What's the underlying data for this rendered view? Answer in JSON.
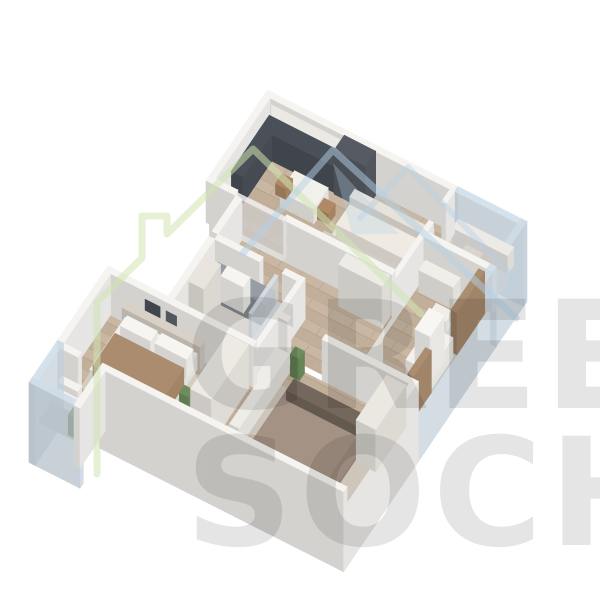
{
  "watermark": {
    "line1": "GREEN",
    "line2": "SOCHI",
    "green_color": "#cfe3b2",
    "blue_color": "#b3cfe6",
    "text_color": "#000000"
  },
  "palette": {
    "background": "#ffffff",
    "wall": "#f5f4f1",
    "glass": "#cfdde8",
    "wood_floor": "#c9b7a3",
    "bath_floor": "#dcd9d4",
    "kitchen_dark": "#4a5058",
    "curtain_brown": "#ab8d70",
    "plant_green": "#6e8d5e",
    "bed_taupe": "#9a897b",
    "blanket_brown": "#ac8c6e"
  },
  "scene": {
    "origin": [
      270,
      140
    ],
    "U": [
      0.75,
      0.38
    ],
    "V": [
      -0.42,
      0.62
    ],
    "items": [
      {
        "t": "box",
        "n": "wall-far-living",
        "u": -8,
        "v": -8,
        "a": 254,
        "b": 8,
        "h": 80,
        "dy": 38,
        "c": "#f5f4f1"
      },
      {
        "t": "decal",
        "n": "kitchen-upper-cabinets",
        "u": 2,
        "v": 0,
        "w": 96,
        "hh": 15,
        "z": 21,
        "c": "#ebe9e4"
      },
      {
        "t": "glass",
        "n": "glazing-office-far",
        "u": 246,
        "v": -8,
        "a": 92,
        "b": 8,
        "h": 80,
        "dy": 38,
        "c": "#cfdde8"
      },
      {
        "t": "box",
        "n": "wall-left-kitchen",
        "u": -8,
        "v": 0,
        "a": 8,
        "b": 130,
        "h": 80,
        "dy": 38,
        "c": "#f5f4f1"
      },
      {
        "t": "floor",
        "n": "floor-living",
        "u": 0,
        "v": 0,
        "a": 240,
        "b": 130,
        "c": "wood"
      },
      {
        "t": "floor",
        "n": "floor-office",
        "u": 246,
        "v": 0,
        "a": 84,
        "b": 65,
        "c": "#d9d4cd"
      },
      {
        "t": "glass",
        "n": "glazing-office-right",
        "u": 330,
        "v": -8,
        "a": 8,
        "b": 73,
        "h": 80,
        "dy": 38,
        "c": "#cfdde8"
      },
      {
        "t": "box",
        "n": "kitchen-counter",
        "u": 0,
        "v": 2,
        "a": 100,
        "b": 22,
        "h": 26,
        "c": "#4a5058"
      },
      {
        "t": "box",
        "n": "kitchen-counter-left",
        "u": 0,
        "v": 24,
        "a": 16,
        "b": 68,
        "h": 26,
        "c": "#4a5058"
      },
      {
        "t": "box",
        "n": "kitchen-tall-cabinet",
        "u": 100,
        "v": 2,
        "a": 42,
        "b": 24,
        "h": 44,
        "c": "#565b63"
      },
      {
        "t": "box",
        "n": "dining-table",
        "u": 55,
        "v": 40,
        "a": 45,
        "b": 34,
        "h": 15,
        "c": "#f2f0ea"
      },
      {
        "t": "box",
        "n": "dining-chair",
        "u": 42,
        "v": 46,
        "a": 14,
        "b": 16,
        "h": 11,
        "c": "#b08a66"
      },
      {
        "t": "box",
        "n": "dining-chair",
        "u": 100,
        "v": 50,
        "a": 15,
        "b": 16,
        "h": 11,
        "c": "#b08a66"
      },
      {
        "t": "floor",
        "n": "rug-living",
        "u": 125,
        "v": 45,
        "a": 113,
        "b": 67,
        "c": "#eae6df"
      },
      {
        "t": "box",
        "n": "sofa-back",
        "u": 132,
        "v": 34,
        "a": 106,
        "b": 12,
        "h": 22,
        "c": "#e7e2da"
      },
      {
        "t": "box",
        "n": "sofa-seat",
        "u": 132,
        "v": 46,
        "a": 106,
        "b": 32,
        "h": 14,
        "c": "#efebe3"
      },
      {
        "t": "box",
        "n": "tv-unit",
        "u": 135,
        "v": 112,
        "a": 97,
        "b": 16,
        "h": 30,
        "c": "#d2ccc4"
      },
      {
        "t": "box",
        "n": "tv-screen",
        "u": 150,
        "v": 116,
        "a": 72,
        "b": 8,
        "h": 28,
        "c": "#272b31"
      },
      {
        "t": "box",
        "n": "plant-pot-living",
        "u": 228,
        "v": 96,
        "a": 12,
        "b": 12,
        "h": 6,
        "c": "#eae7e1"
      },
      {
        "t": "box",
        "n": "plant-living",
        "u": 228,
        "v": 96,
        "a": 12,
        "b": 12,
        "h": 18,
        "dy": -6,
        "c": "#6e8d5e"
      },
      {
        "t": "box",
        "n": "office-desk",
        "u": 252,
        "v": 2,
        "a": 74,
        "b": 14,
        "h": 18,
        "c": "#eceae5"
      },
      {
        "t": "box",
        "n": "office-chair",
        "u": 274,
        "v": 22,
        "a": 22,
        "b": 18,
        "h": 13,
        "c": "#d9d5ce"
      },
      {
        "t": "box",
        "n": "wall-living-divider",
        "u": 240,
        "v": 0,
        "a": 6,
        "b": 20,
        "h": 42,
        "c": "#f5f4f1"
      },
      {
        "t": "box",
        "n": "wall-living-divider",
        "u": 240,
        "v": 50,
        "a": 6,
        "b": 145,
        "h": 42,
        "c": "#f5f4f1"
      },
      {
        "t": "box",
        "n": "wall-living-divider",
        "u": 240,
        "v": 212,
        "a": 6,
        "b": 38,
        "h": 42,
        "c": "#f5f4f1"
      },
      {
        "t": "box",
        "n": "wall-office-nursery",
        "u": 246,
        "v": 65,
        "a": 92,
        "b": 8,
        "h": 42,
        "c": "#f5f4f1"
      },
      {
        "t": "floor",
        "n": "floor-nursery",
        "u": 246,
        "v": 73,
        "a": 84,
        "b": 177,
        "c": "wood"
      },
      {
        "t": "glass",
        "n": "glazing-right",
        "u": 330,
        "v": 65,
        "a": 8,
        "b": 185,
        "h": 80,
        "dy": 38,
        "c": "#cfdde8"
      },
      {
        "t": "box",
        "n": "nursery-dresser",
        "u": 250,
        "v": 76,
        "a": 46,
        "b": 16,
        "h": 22,
        "c": "#f0eee9"
      },
      {
        "t": "box",
        "n": "nursery-table",
        "u": 282,
        "v": 108,
        "a": 22,
        "b": 16,
        "h": 11,
        "c": "#f0eee9"
      },
      {
        "t": "box",
        "n": "nursery-chair",
        "u": 300,
        "v": 94,
        "a": 15,
        "b": 14,
        "h": 9,
        "c": "#efece6"
      },
      {
        "t": "box",
        "n": "curtain-nursery",
        "u": 322,
        "v": 78,
        "a": 8,
        "b": 66,
        "h": 42,
        "c": "#ab8d70"
      },
      {
        "t": "box",
        "n": "crib",
        "u": 296,
        "v": 150,
        "a": 32,
        "b": 55,
        "h": 20,
        "c": "#f3f1ec"
      },
      {
        "t": "box",
        "n": "crib-canopy",
        "u": 302,
        "v": 160,
        "a": 20,
        "b": 34,
        "h": 46,
        "c": "#f7f6f3"
      },
      {
        "t": "box",
        "n": "curtain-nursery",
        "u": 322,
        "v": 205,
        "a": 8,
        "b": 42,
        "h": 42,
        "c": "#ab8d70"
      },
      {
        "t": "box",
        "n": "nursery-wardrobe",
        "u": 248,
        "v": 210,
        "a": 20,
        "b": 38,
        "h": 42,
        "c": "#efede7"
      },
      {
        "t": "box",
        "n": "wall-living-hall",
        "u": -8,
        "v": 130,
        "a": 38,
        "b": 8,
        "h": 42,
        "c": "#f5f4f1"
      },
      {
        "t": "box",
        "n": "wall-living-hall",
        "u": 95,
        "v": 130,
        "a": 145,
        "b": 8,
        "h": 42,
        "c": "#f5f4f1"
      },
      {
        "t": "glass",
        "n": "sheer-curtain",
        "u": 30,
        "v": 131,
        "a": 65,
        "b": 6,
        "h": 40,
        "c": "#f1f1ef"
      },
      {
        "t": "box",
        "n": "wall-left-hall",
        "u": 32,
        "v": 138,
        "a": 8,
        "b": 57,
        "h": 80,
        "dy": 38,
        "c": "#f5f4f1"
      },
      {
        "t": "floor",
        "n": "floor-hall",
        "u": 40,
        "v": 138,
        "a": 200,
        "b": 57,
        "c": "wood"
      },
      {
        "t": "box",
        "n": "hall-wardrobe",
        "u": 180,
        "v": 140,
        "a": 58,
        "b": 18,
        "h": 42,
        "c": "#edebe5"
      },
      {
        "t": "box",
        "n": "plant-pot-hall",
        "u": 44,
        "v": 180,
        "a": 11,
        "b": 11,
        "h": 5,
        "c": "#eae7e1"
      },
      {
        "t": "box",
        "n": "plant-hall",
        "u": 44,
        "v": 180,
        "a": 11,
        "b": 11,
        "h": 16,
        "dy": -5,
        "c": "#6e8d5e"
      },
      {
        "t": "box",
        "n": "wall-hall-bath",
        "u": 40,
        "v": 195,
        "a": 60,
        "b": 8,
        "h": 42,
        "c": "#f5f4f1"
      },
      {
        "t": "box",
        "n": "wall-hall-bath",
        "u": 130,
        "v": 195,
        "a": 26,
        "b": 8,
        "h": 42,
        "c": "#f5f4f1"
      },
      {
        "t": "box",
        "n": "wall-left-bath",
        "u": 32,
        "v": 203,
        "a": 8,
        "b": 97,
        "h": 80,
        "dy": 38,
        "c": "#f5f4f1"
      },
      {
        "t": "floor",
        "n": "floor-bath",
        "u": 40,
        "v": 203,
        "a": 110,
        "b": 97,
        "c": "#dcd9d4"
      },
      {
        "t": "box",
        "n": "bath-vanity",
        "u": 46,
        "v": 206,
        "a": 76,
        "b": 22,
        "h": 23,
        "c": "#979da4"
      },
      {
        "t": "box",
        "n": "bath-sink",
        "u": 60,
        "v": 208,
        "a": 30,
        "b": 16,
        "h": 26,
        "c": "#f6f5f2"
      },
      {
        "t": "glass",
        "n": "shower-glass",
        "u": 122,
        "v": 206,
        "a": 4,
        "b": 62,
        "h": 40,
        "c": "#dfe7ed"
      },
      {
        "t": "box",
        "n": "shower-tray",
        "u": 126,
        "v": 206,
        "a": 24,
        "b": 62,
        "h": 14,
        "c": "#d9dde0"
      },
      {
        "t": "box",
        "n": "bath-cabinet",
        "u": 44,
        "v": 232,
        "a": 20,
        "b": 40,
        "h": 44,
        "c": "#e9e5de"
      },
      {
        "t": "box",
        "n": "toilet",
        "u": 46,
        "v": 276,
        "a": 20,
        "b": 20,
        "h": 16,
        "c": "#f6f5f2"
      },
      {
        "t": "box",
        "n": "wall-bath-corridor",
        "u": 150,
        "v": 195,
        "a": 6,
        "b": 225,
        "h": 42,
        "c": "#f5f4f1"
      },
      {
        "t": "floor",
        "n": "floor-corridor",
        "u": 156,
        "v": 195,
        "a": 84,
        "b": 55,
        "c": "wood"
      },
      {
        "t": "box",
        "n": "wall-corridor-master",
        "u": 156,
        "v": 250,
        "a": 12,
        "b": 8,
        "h": 42,
        "c": "#f5f4f1"
      },
      {
        "t": "box",
        "n": "wall-corridor-master",
        "u": 214,
        "v": 250,
        "a": 116,
        "b": 8,
        "h": 42,
        "c": "#f5f4f1"
      },
      {
        "t": "floor",
        "n": "floor-master",
        "u": 156,
        "v": 258,
        "a": 174,
        "b": 162,
        "c": "wood"
      },
      {
        "t": "box",
        "n": "wall-right-master",
        "u": 330,
        "v": 250,
        "a": 8,
        "b": 178,
        "h": 80,
        "dy": 38,
        "c": "#f5f4f1"
      },
      {
        "t": "floor",
        "n": "rug-master",
        "u": 176,
        "v": 288,
        "a": 144,
        "b": 126,
        "c": "#cfc6bb"
      },
      {
        "t": "box",
        "n": "master-console",
        "u": 158,
        "v": 268,
        "a": 18,
        "b": 120,
        "h": 19,
        "c": "#efede8"
      },
      {
        "t": "box",
        "n": "plant-master",
        "u": 179,
        "v": 259,
        "a": 12,
        "b": 12,
        "h": 22,
        "c": "#6e8d5e"
      },
      {
        "t": "box",
        "n": "master-bed",
        "u": 196,
        "v": 300,
        "a": 104,
        "b": 105,
        "h": 17,
        "c": "#9a897b"
      },
      {
        "t": "box",
        "n": "master-pillows",
        "u": 200,
        "v": 300,
        "a": 96,
        "b": 18,
        "h": 23,
        "c": "#74675c"
      },
      {
        "t": "box",
        "n": "master-blanket",
        "u": 198,
        "v": 326,
        "a": 100,
        "b": 77,
        "h": 19,
        "c": "#a49385"
      },
      {
        "t": "box",
        "n": "master-pouf",
        "u": 176,
        "v": 398,
        "a": 17,
        "b": 16,
        "h": 10,
        "c": "#b59b80"
      },
      {
        "t": "box",
        "n": "master-wardrobe",
        "u": 302,
        "v": 262,
        "a": 26,
        "b": 72,
        "h": 42,
        "c": "#ebe8e2"
      },
      {
        "t": "box",
        "n": "wall-bath-bedroom2",
        "u": -48,
        "v": 300,
        "a": 198,
        "b": 8,
        "h": 42,
        "c": "#f5f4f1"
      },
      {
        "t": "decal",
        "n": "wall-picture",
        "u": 6,
        "v": 308,
        "w": 20,
        "hh": 18,
        "z": 16,
        "c": "#41464c"
      },
      {
        "t": "decal",
        "n": "wall-picture",
        "u": 34,
        "v": 308,
        "w": 14,
        "hh": 13,
        "z": 20,
        "c": "#52575d"
      },
      {
        "t": "box",
        "n": "wall-left-bedroom2",
        "u": -48,
        "v": 308,
        "a": 8,
        "b": 112,
        "h": 80,
        "dy": 38,
        "c": "#f5f4f1"
      },
      {
        "t": "floor",
        "n": "floor-bedroom2",
        "u": -40,
        "v": 308,
        "a": 190,
        "b": 112,
        "c": "wood"
      },
      {
        "t": "floor",
        "n": "rug-bedroom2",
        "u": -22,
        "v": 326,
        "a": 122,
        "b": 86,
        "c": "#d5cdc2"
      },
      {
        "t": "box",
        "n": "bed2-headboard",
        "u": -18,
        "v": 310,
        "a": 104,
        "b": 10,
        "h": 24,
        "c": "#d8d1c7"
      },
      {
        "t": "box",
        "n": "bed2",
        "u": -14,
        "v": 320,
        "a": 96,
        "b": 84,
        "h": 16,
        "c": "#f0eee8"
      },
      {
        "t": "box",
        "n": "bed2-pillow",
        "u": -10,
        "v": 322,
        "a": 40,
        "b": 16,
        "h": 20,
        "c": "#f6f5f1"
      },
      {
        "t": "box",
        "n": "bed2-pillow",
        "u": 36,
        "v": 322,
        "a": 42,
        "b": 16,
        "h": 20,
        "c": "#f6f5f1"
      },
      {
        "t": "box",
        "n": "bed2-blanket",
        "u": -12,
        "v": 348,
        "a": 92,
        "b": 52,
        "h": 18,
        "c": "#ac8c6e"
      },
      {
        "t": "box",
        "n": "nightstand-bedroom2",
        "u": 90,
        "v": 390,
        "a": 20,
        "b": 20,
        "h": 13,
        "c": "#f1efe9"
      },
      {
        "t": "box",
        "n": "plant-bedroom2",
        "u": 92,
        "v": 368,
        "a": 12,
        "b": 12,
        "h": 18,
        "c": "#6e8d5e"
      },
      {
        "t": "box",
        "n": "wardrobe-bedroom2",
        "u": 118,
        "v": 312,
        "a": 28,
        "b": 88,
        "h": 44,
        "c": "#edeae4"
      },
      {
        "t": "box",
        "n": "wall-near-bedroom2",
        "u": -40,
        "v": 420,
        "a": 24,
        "b": 8,
        "h": 80,
        "dy": 38,
        "c": "#f5f4f1"
      },
      {
        "t": "box",
        "n": "wall-near-bedroom2",
        "u": 12,
        "v": 420,
        "a": 138,
        "b": 8,
        "h": 80,
        "dy": 38,
        "c": "#f5f4f1"
      },
      {
        "t": "box",
        "n": "wall-near-master",
        "u": 150,
        "v": 420,
        "a": 188,
        "b": 8,
        "h": 80,
        "dy": 38,
        "c": "#f5f4f1"
      },
      {
        "t": "floor",
        "n": "floor-balcony",
        "u": -40,
        "v": 428,
        "a": 52,
        "b": 52,
        "c": "#d7d2cb"
      },
      {
        "t": "box",
        "n": "balcony-armchair-back",
        "u": -34,
        "v": 434,
        "a": 26,
        "b": 9,
        "h": 20,
        "c": "#f4f3ef"
      },
      {
        "t": "box",
        "n": "balcony-armchair",
        "u": -34,
        "v": 443,
        "a": 26,
        "b": 20,
        "h": 13,
        "c": "#f4f3ef"
      },
      {
        "t": "box",
        "n": "balcony-table",
        "u": -4,
        "v": 446,
        "a": 14,
        "b": 15,
        "h": 11,
        "c": "#797d80"
      },
      {
        "t": "box",
        "n": "plant-balcony",
        "u": -2,
        "v": 464,
        "a": 13,
        "b": 13,
        "h": 20,
        "c": "#6e8d5e"
      },
      {
        "t": "glass",
        "n": "glazing-balcony-left",
        "u": -48,
        "v": 420,
        "a": 8,
        "b": 68,
        "h": 80,
        "dy": 38,
        "c": "#cfdde8"
      },
      {
        "t": "glass",
        "n": "glazing-balcony-near",
        "u": -48,
        "v": 480,
        "a": 68,
        "b": 8,
        "h": 80,
        "dy": 38,
        "c": "#cfdde8"
      },
      {
        "t": "box",
        "n": "wall-balcony-end",
        "u": 12,
        "v": 428,
        "a": 8,
        "b": 60,
        "h": 60,
        "dy": 18,
        "c": "#f5f4f1"
      }
    ]
  }
}
